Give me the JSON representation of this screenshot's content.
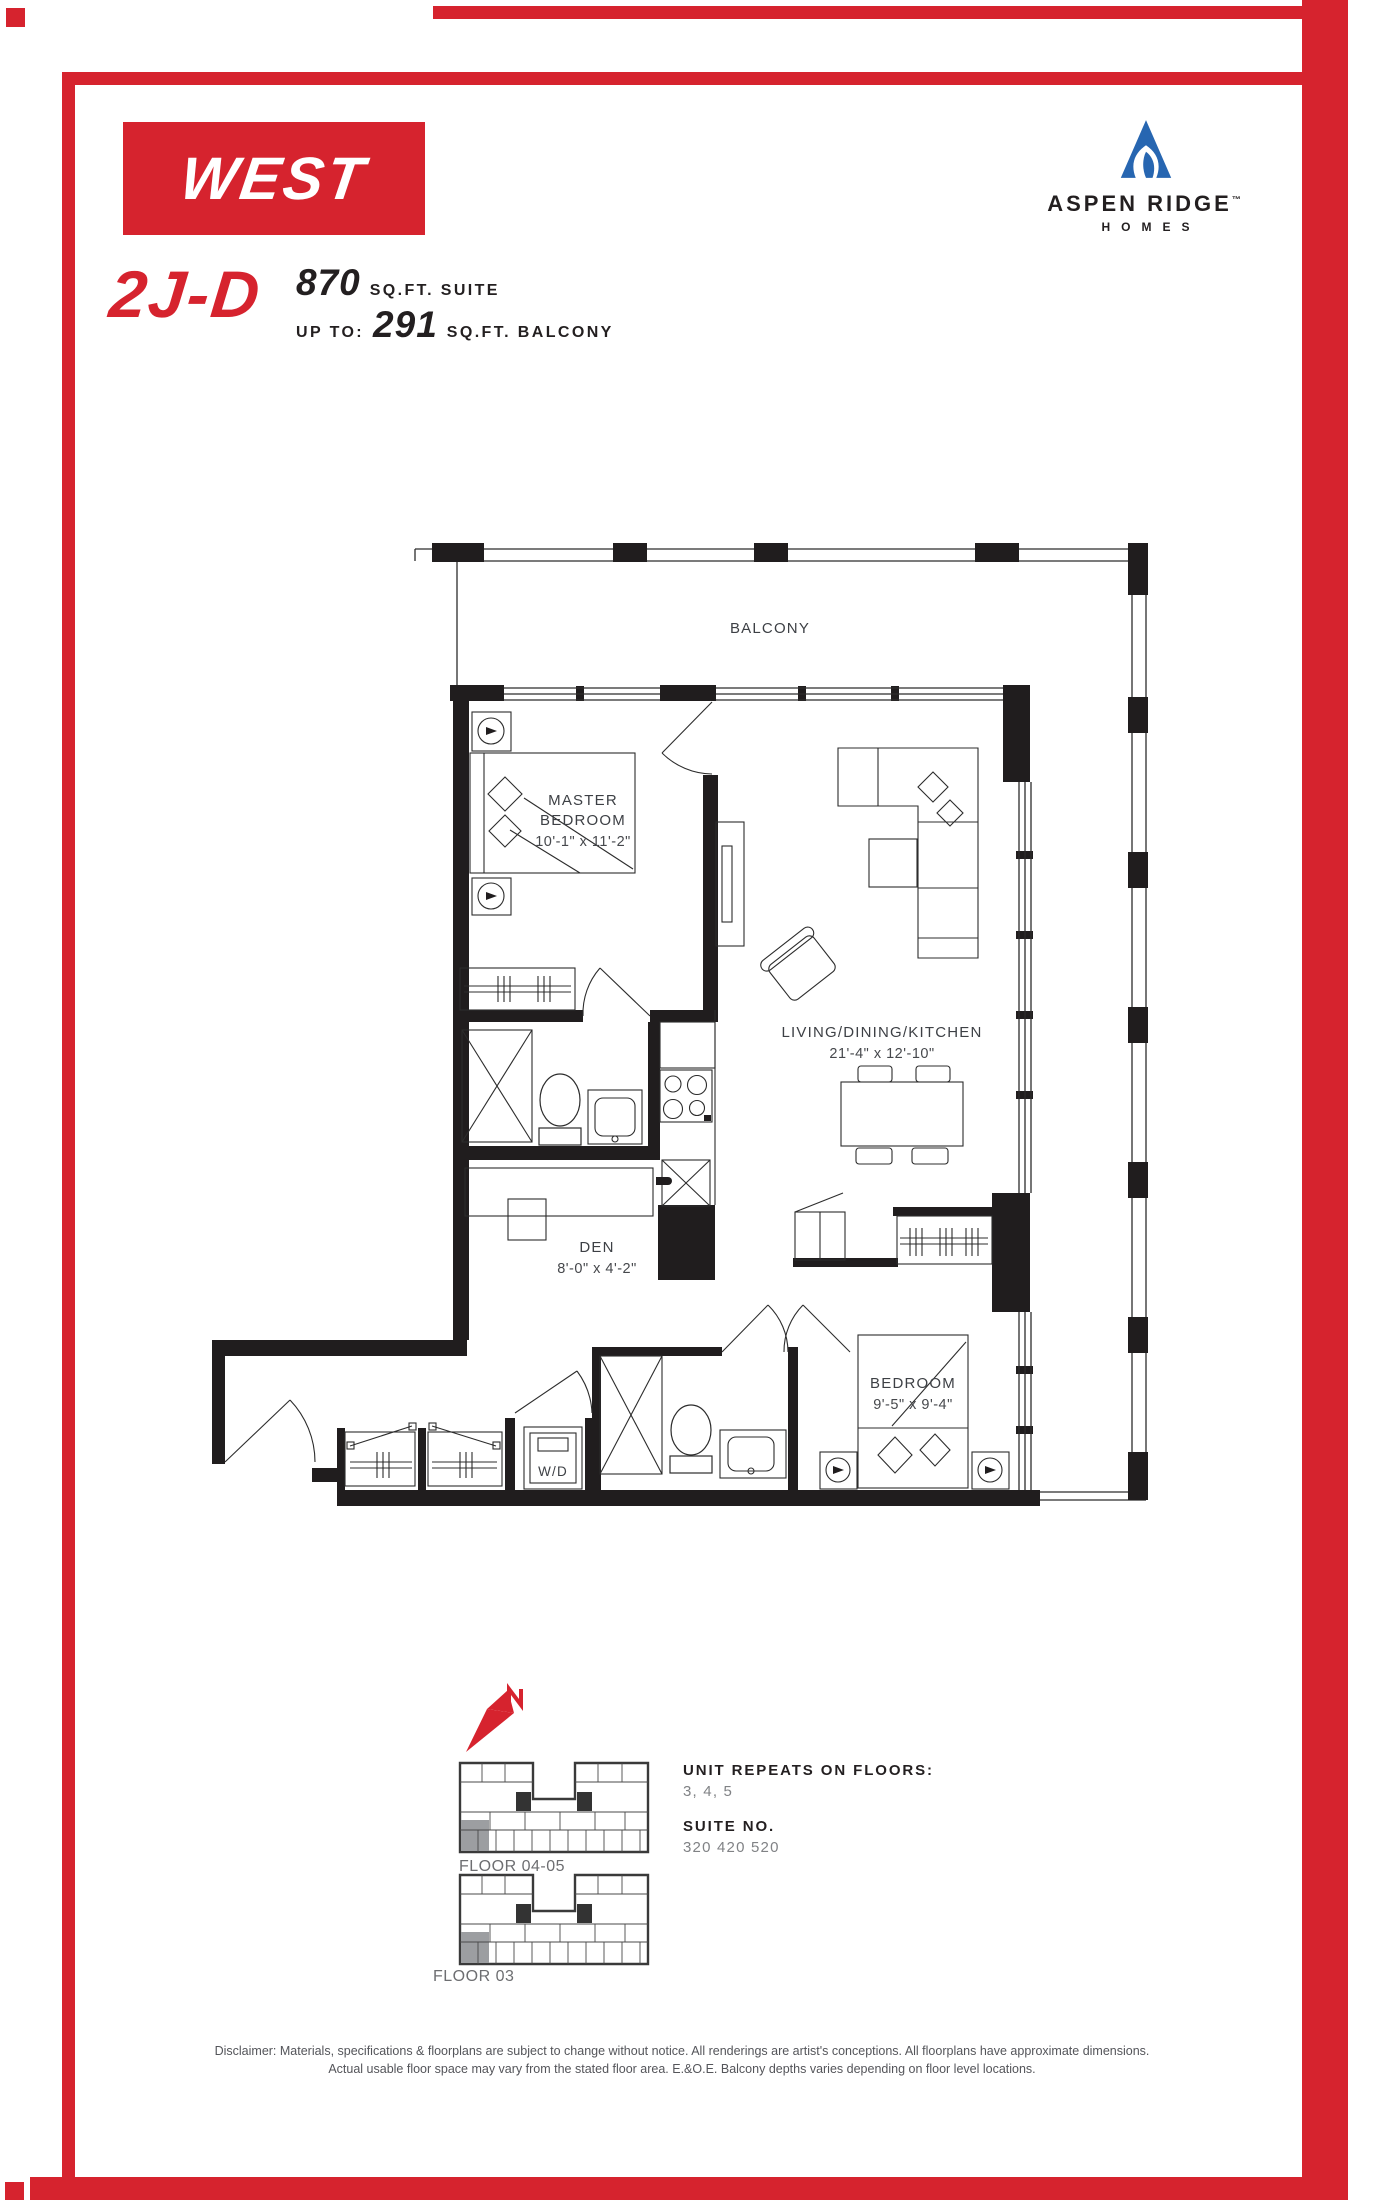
{
  "header": {
    "building_logo": "WEST",
    "brand": {
      "name": "ASPEN RIDGE",
      "trademark": "™",
      "sub": "HOMES"
    }
  },
  "title": {
    "unit_code": "2J-D",
    "suite_area": "870",
    "suite_area_unit": "SQ.FT. SUITE",
    "balcony_prefix": "UP TO:",
    "balcony_area": "291",
    "balcony_area_unit": "SQ.FT. BALCONY"
  },
  "floorplan": {
    "labels": {
      "balcony": "BALCONY",
      "master_line1": "MASTER",
      "master_line2": "BEDROOM",
      "master_dims": "10'-1\" x 11'-2\"",
      "living": "LIVING/DINING/KITCHEN",
      "living_dims": "21'-4\" x 12'-10\"",
      "den": "DEN",
      "den_dims": "8'-0\" x 4'-2\"",
      "bedroom": "BEDROOM",
      "bedroom_dims": "9'-5\" x 9'-4\"",
      "wd": "W/D"
    }
  },
  "keyplans": [
    {
      "label": "FLOOR 04-05"
    },
    {
      "label": "FLOOR 03"
    }
  ],
  "info": {
    "repeats_label": "UNIT REPEATS ON FLOORS:",
    "repeats_value": "3, 4, 5",
    "suite_label": "SUITE NO.",
    "suite_value": "320 420 520"
  },
  "disclaimer": {
    "line1": "Disclaimer: Materials, specifications & floorplans are subject to change without notice. All renderings are artist's conceptions. All floorplans have approximate dimensions.",
    "line2": "Actual usable floor space may vary from the stated floor area. E.&O.E. Balcony depths varies depending on floor level locations.",
    "colors_note": ""
  },
  "colors": {
    "accent_red": "#D6232E",
    "brand_blue": "#2766B1",
    "text_dark": "#231F20",
    "text_gray": "#808285"
  }
}
